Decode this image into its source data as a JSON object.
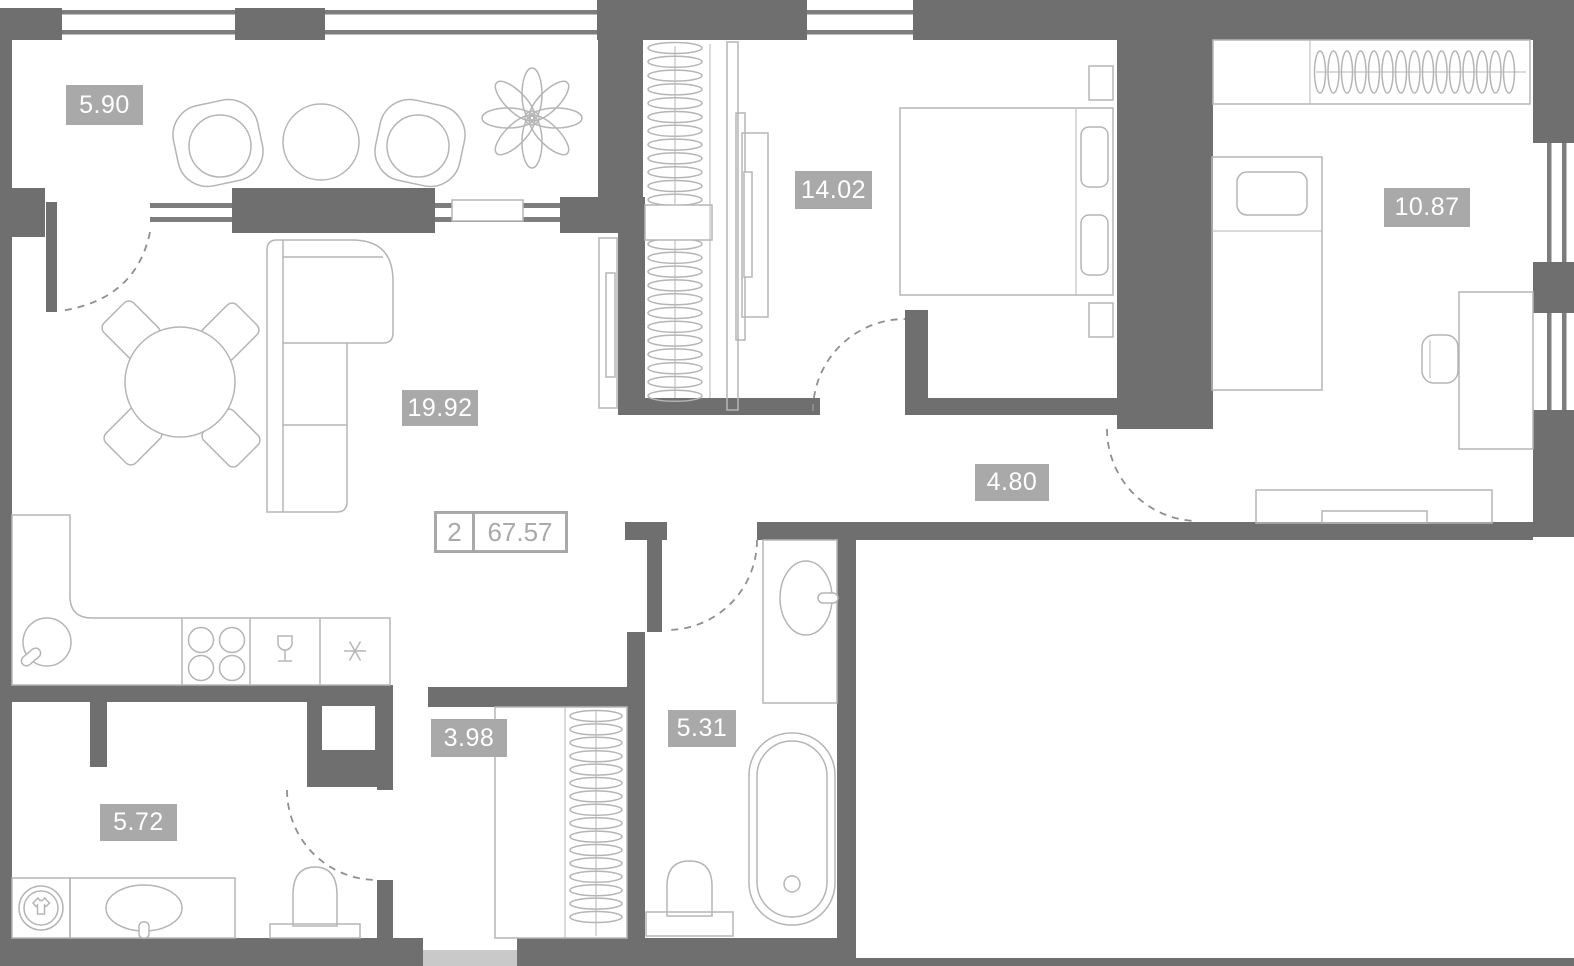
{
  "plan": {
    "title": "2-room apartment floor plan",
    "summary": {
      "rooms_count": "2",
      "total_area": "67.57"
    },
    "rooms": [
      {
        "name": "balcony",
        "area": "5.90"
      },
      {
        "name": "living-room-kitchen",
        "area": "19.92"
      },
      {
        "name": "bedroom",
        "area": "14.02"
      },
      {
        "name": "bedroom-2",
        "area": "10.87"
      },
      {
        "name": "corridor",
        "area": "4.80"
      },
      {
        "name": "entry-hall",
        "area": "3.98"
      },
      {
        "name": "bathroom",
        "area": "5.31"
      },
      {
        "name": "bathroom-2",
        "area": "5.72"
      }
    ],
    "colors": {
      "wall": "#6f6f6f",
      "furniture_outline": "#b5b5b5",
      "area_label_bg": "#a9a9a9",
      "area_label_text": "#ffffff",
      "total_label": "#a9a9a9",
      "door_threshold": "#c9c9c9",
      "background": "#ffffff"
    }
  }
}
